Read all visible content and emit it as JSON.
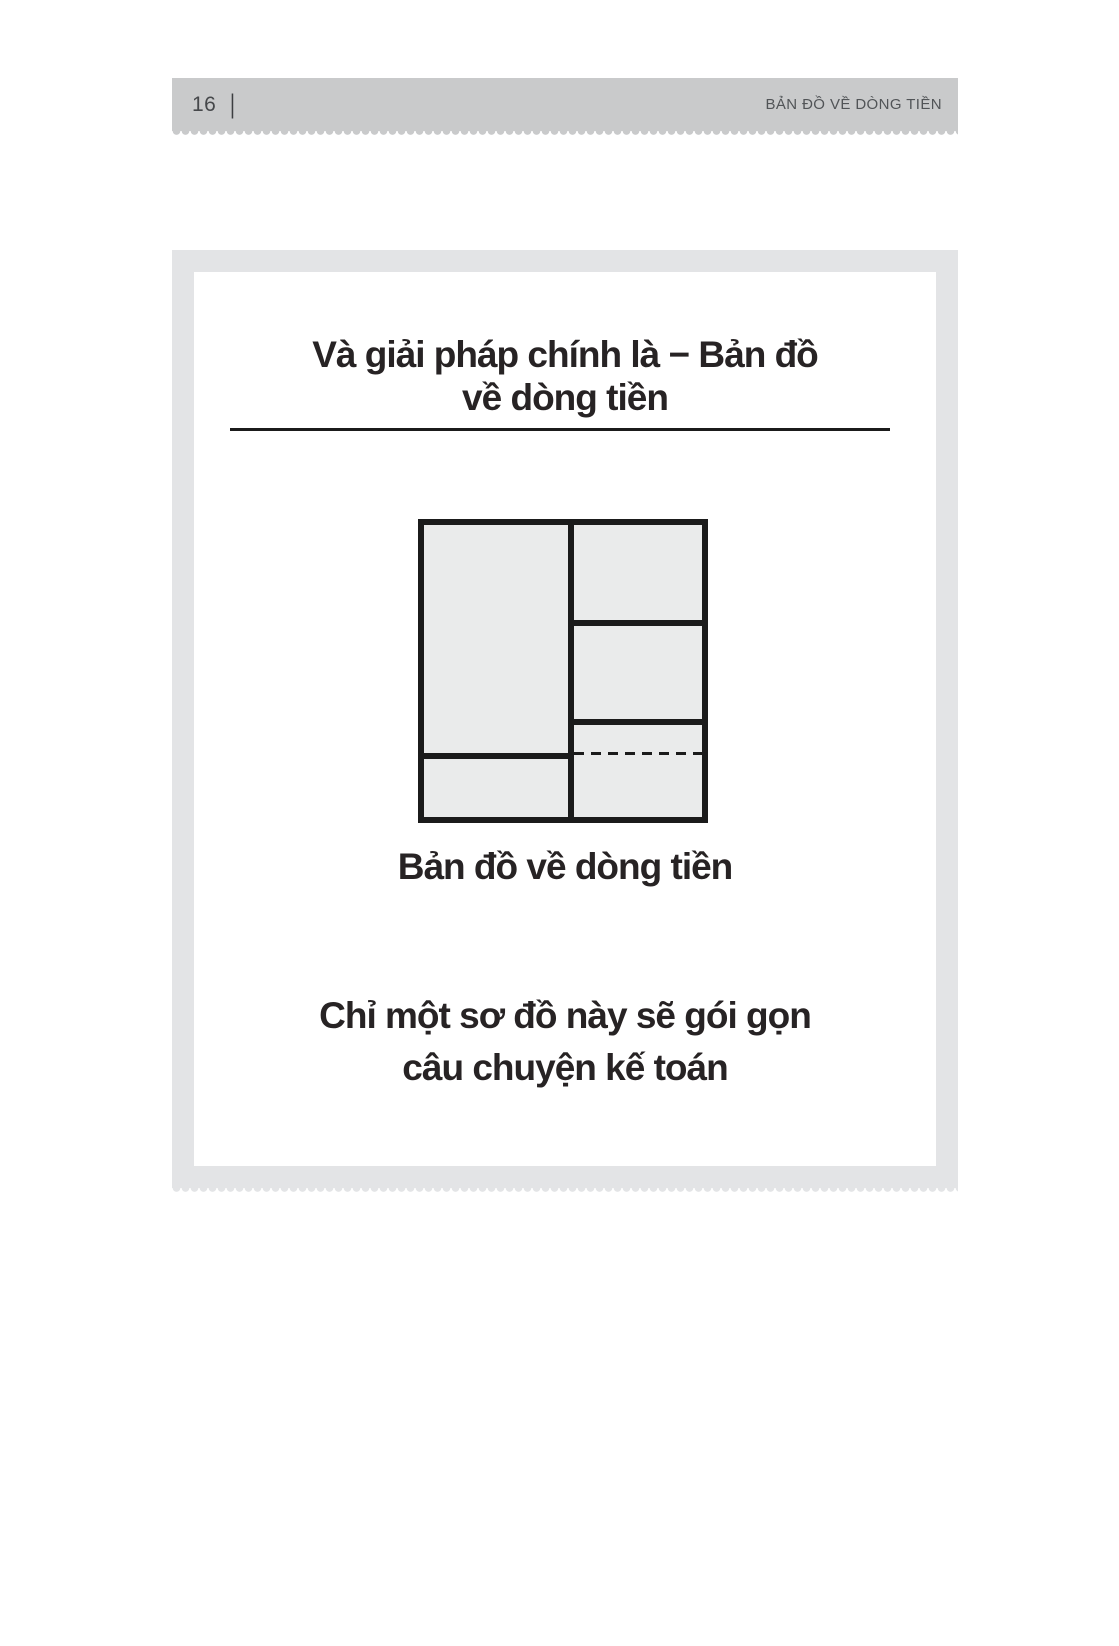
{
  "header": {
    "page_number": "16",
    "separator": "|",
    "running_title": "BẢN ĐỒ VỀ DÒNG TIỀN"
  },
  "slide": {
    "title": {
      "line1": "Và giải pháp chính là − Bản đồ",
      "line2": "về dòng tiền"
    },
    "diagram_caption": "Bản đồ về dòng tiền",
    "body": {
      "line1": "Chỉ một sơ đồ này sẽ gói gọn",
      "line2": "câu chuyện kế toán"
    }
  },
  "colors": {
    "header_bar": "#c9cacb",
    "slide_background": "#e3e4e6",
    "panel_background": "#ffffff",
    "diagram_line": "#1b1b1b",
    "diagram_cell_fill": "#eaebeb",
    "text": "#272324",
    "header_text": "#515457"
  }
}
